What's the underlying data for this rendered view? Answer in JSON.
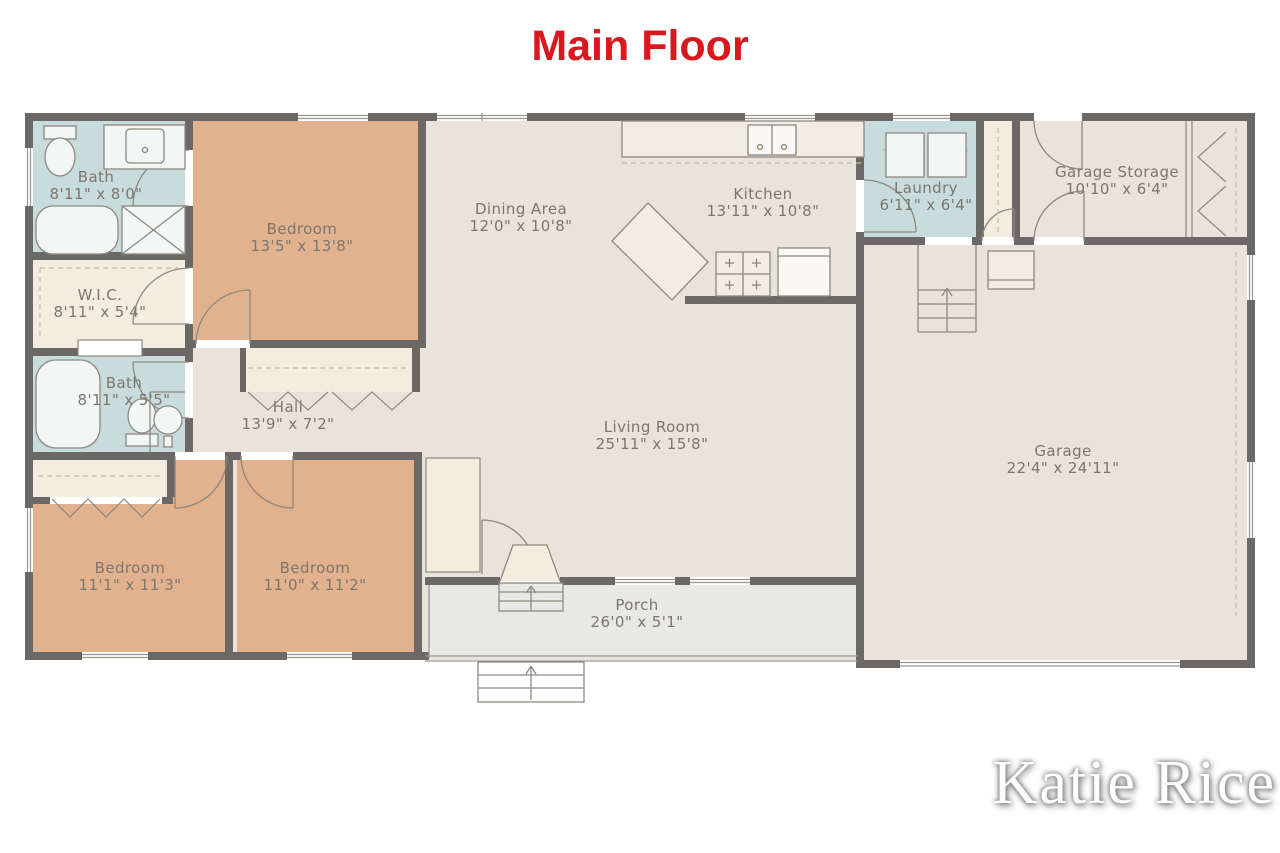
{
  "title": "Main Floor",
  "watermark": "Katie Rice",
  "rooms": [
    {
      "id": "bath-main",
      "name": "Bath",
      "dims": "8'11\" x 8'0\""
    },
    {
      "id": "wic",
      "name": "W.I.C.",
      "dims": "8'11\" x 5'4\""
    },
    {
      "id": "bath-hall",
      "name": "Bath",
      "dims": "8'11\" x 5'5\""
    },
    {
      "id": "bedroom-primary",
      "name": "Bedroom",
      "dims": "13'5\" x 13'8\""
    },
    {
      "id": "dining-area",
      "name": "Dining Area",
      "dims": "12'0\" x 10'8\""
    },
    {
      "id": "kitchen",
      "name": "Kitchen",
      "dims": "13'11\" x 10'8\""
    },
    {
      "id": "laundry",
      "name": "Laundry",
      "dims": "6'11\" x 6'4\""
    },
    {
      "id": "garage-storage",
      "name": "Garage Storage",
      "dims": "10'10\" x 6'4\""
    },
    {
      "id": "hall",
      "name": "Hall",
      "dims": "13'9\" x 7'2\""
    },
    {
      "id": "living-room",
      "name": "Living Room",
      "dims": "25'11\" x 15'8\""
    },
    {
      "id": "garage",
      "name": "Garage",
      "dims": "22'4\" x 24'11\""
    },
    {
      "id": "bedroom-left",
      "name": "Bedroom",
      "dims": "11'1\" x 11'3\""
    },
    {
      "id": "bedroom-middle",
      "name": "Bedroom",
      "dims": "11'0\" x 11'2\""
    },
    {
      "id": "porch",
      "name": "Porch",
      "dims": "26'0\" x 5'1\""
    }
  ],
  "colors": {
    "title_red": "#d81920",
    "wall": "#6b6866",
    "floor": "#eae3dc",
    "bedroom_fill": "#e2b18e",
    "bath_fill": "#c9dcdd",
    "closet_fill": "#f3ecdf",
    "porch_fill": "#e8e8e6",
    "label_text": "#7c766e",
    "fixture_line": "#8e887f"
  }
}
